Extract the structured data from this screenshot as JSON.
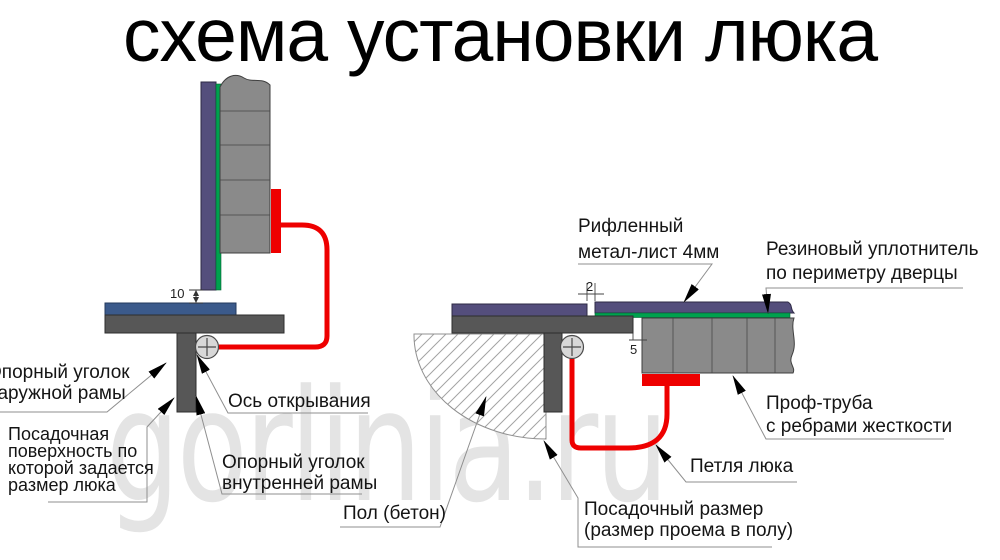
{
  "title": "схема установки люка",
  "watermark": "gorlinia.ru",
  "colors": {
    "purple": "#544e7c",
    "green": "#00a14e",
    "blue": "#3b5a8b",
    "gray": "#8a8a8a",
    "dark_gray": "#575757",
    "red": "#ee0000",
    "circle_fill": "#d8d8d8",
    "watermark": "#e4e4e4"
  },
  "labels": {
    "outer_angle": [
      "Опорный уголок",
      "наружной рамы"
    ],
    "seat_surface": [
      "Посадочная",
      "поверхность по",
      "которой задается",
      "размер люка"
    ],
    "axis": [
      "Ось открывания"
    ],
    "inner_angle": [
      "Опорный уголок",
      "внутренней рамы"
    ],
    "floor": [
      "Пол (бетон)"
    ],
    "sheet": [
      "Рифленный",
      "метал-лист 4мм"
    ],
    "rubber": [
      "Резиновый уплотнитель",
      "по периметру дверцы"
    ],
    "proftube": [
      "Проф-труба",
      "с ребрами жесткости"
    ],
    "hinge": [
      "Петля люка"
    ],
    "seat_size": [
      "Посадочный размер",
      "(размер проема в полу)"
    ]
  },
  "dimensions": {
    "lid_gap_mm": "10",
    "sheet_gap_mm": "2",
    "side_gap_mm": "5"
  }
}
